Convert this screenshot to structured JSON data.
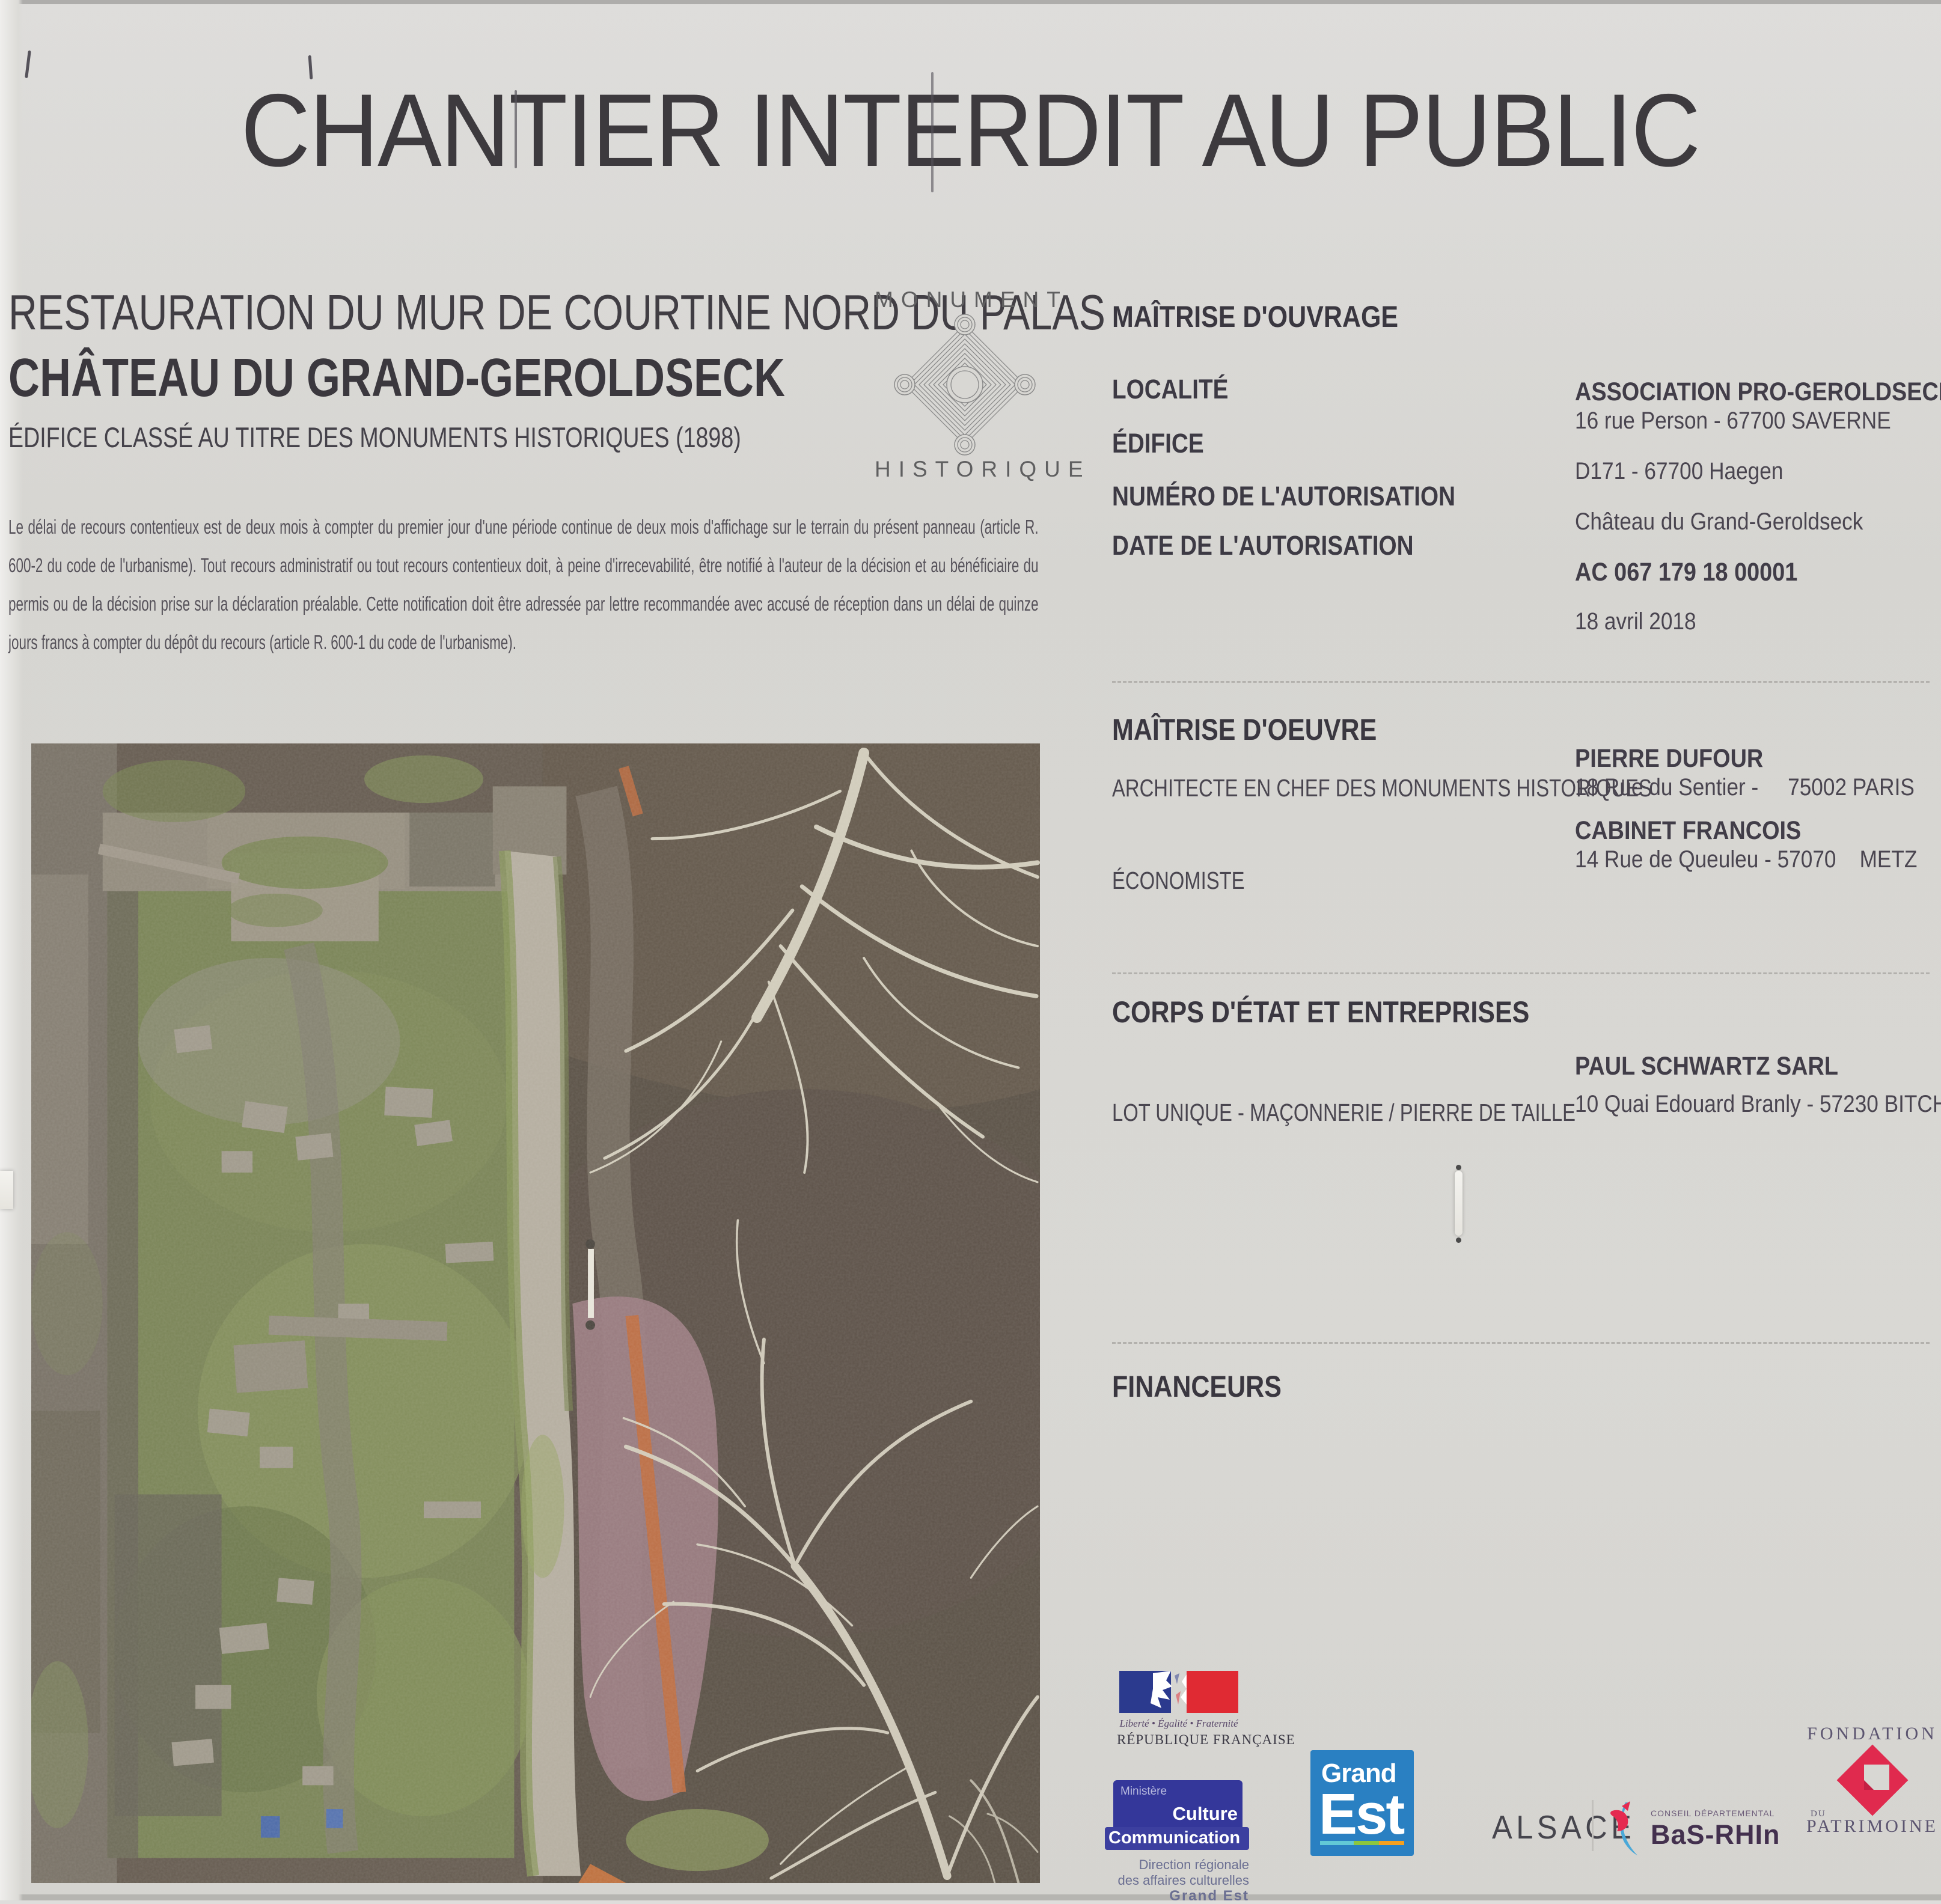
{
  "title": "CHANTIER INTERDIT AU PUBLIC",
  "project": {
    "line1": "RESTAURATION DU MUR DE COURTINE NORD DU PALAS",
    "line2": "CHÂTEAU DU GRAND-GEROLDSECK",
    "line3": "ÉDIFICE CLASSÉ AU TITRE DES MONUMENTS HISTORIQUES (1898)",
    "legal_text": "Le délai de recours contentieux est de deux mois à compter du premier jour d'une période continue de deux mois d'affichage sur le terrain du présent panneau (article R. 600-2 du code de l'urbanisme). Tout recours administratif ou tout recours contentieux doit, à peine d'irrecevabilité, être notifié à l'auteur de la décision et au bénéficiaire du permis ou de la décision prise sur la déclaration préalable. Cette notification doit être adressée par lettre recommandée avec accusé de réception dans un délai de quinze jours francs à compter du dépôt du recours (article R. 600-1 du code de l'urbanisme)."
  },
  "monument_badge": {
    "top": "MONUMENT",
    "bottom": "HISTORIQUE",
    "symbol": "labyrinth-diamond-icon"
  },
  "maitrise_ouvrage": {
    "heading": "MAÎTRISE D'OUVRAGE",
    "label_localite": "LOCALITÉ",
    "label_edifice": "ÉDIFICE",
    "label_numero": "NUMÉRO DE L'AUTORISATION",
    "label_date": "DATE DE L'AUTORISATION",
    "org_name": "ASSOCIATION PRO-GEROLDSECK",
    "org_address": "16 rue Person - 67700 SAVERNE",
    "localite_value": "D171 - 67700 Haegen",
    "edifice_value": "Château du Grand-Geroldseck",
    "numero_value": "AC 067 179 18 00001",
    "date_value": "18  avril 2018"
  },
  "maitrise_oeuvre": {
    "heading": "MAÎTRISE D'OEUVRE",
    "label_architecte": "ARCHITECTE EN CHEF DES MONUMENTS HISTORIQUES",
    "label_economiste": "ÉCONOMISTE",
    "architecte_name": "PIERRE DUFOUR",
    "architecte_address": "18 Rue du Sentier -     75002 PARIS",
    "economiste_name": "CABINET FRANCOIS",
    "economiste_address": "14 Rue de Queuleu - 57070    METZ"
  },
  "corps_etat": {
    "heading": "CORPS D'ÉTAT ET ENTREPRISES",
    "label_lot": "LOT UNIQUE - MAÇONNERIE / PIERRE DE TAILLE",
    "entreprise_name": "PAUL SCHWARTZ SARL",
    "entreprise_address": "10 Quai Edouard Branly - 57230 BITCHE"
  },
  "financeurs": {
    "heading": "FINANCEURS",
    "republique": {
      "motto": "Liberté • Égalité • Fraternité",
      "name": "RÉPUBLIQUE FRANÇAISE",
      "icon": "french-flag-marianne-icon"
    },
    "ministere": {
      "ministere": "Ministère",
      "culture": "Culture",
      "communication": "Communication",
      "sub1": "Direction régionale",
      "sub2": "des affaires culturelles",
      "sub3": "Grand Est"
    },
    "grand_est": {
      "line1": "Grand",
      "line2": "Est"
    },
    "alsace_label": "ALSACE",
    "bas_rhin": {
      "sup": "CONSEIL DÉPARTEMENTAL",
      "name": "BaS-RHIn",
      "icon": "bas-rhin-heart-swoosh-icon"
    },
    "fondation": {
      "line1": "FONDATION",
      "du": "DU",
      "line2": "PATRIMOINE",
      "icon": "red-diamond-icon"
    }
  },
  "photo": {
    "name": "aerial-photo-castle-ruins"
  },
  "colors": {
    "panel_bg": "#d8d7d3",
    "text_dark": "#3d3a3e",
    "flag_blue": "#2b3a8e",
    "flag_red": "#e02a33",
    "ministere_blue": "#34379a",
    "grand_est_blue": "#2a80c2",
    "stripe_teal": "#62c9d6",
    "stripe_green": "#8cc63f",
    "stripe_orange": "#f5a01e",
    "bas_rhin_red": "#e52a50",
    "bas_rhin_swoosh": "#4aa8d8",
    "bas_rhin_text": "#43304e",
    "fondation_red": "#e02a4e",
    "fondation_text": "#5c5570"
  }
}
